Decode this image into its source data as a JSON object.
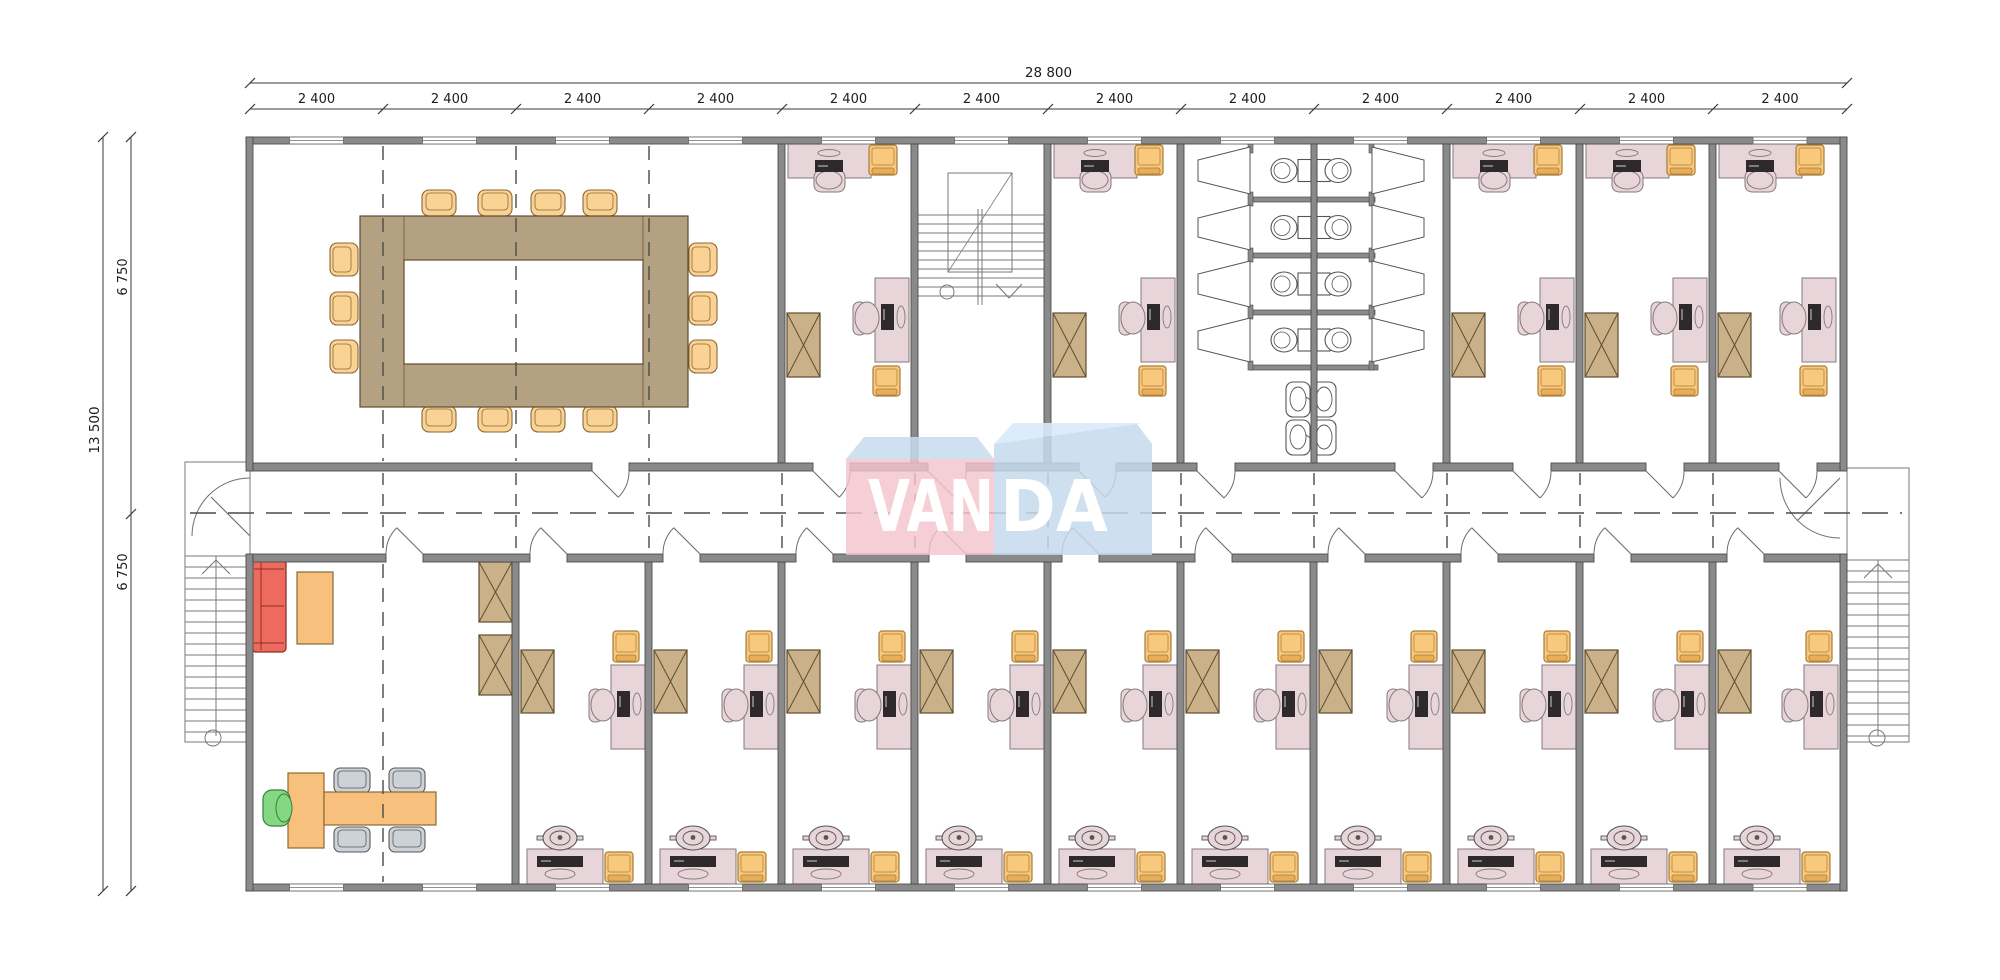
{
  "watermark": {
    "left_text": "VAN",
    "right_text": "DA"
  },
  "dimensions": {
    "top_total_label": "28 800",
    "top_segment_labels": [
      "2 400",
      "2 400",
      "2 400",
      "2 400",
      "2 400",
      "2 400",
      "2 400",
      "2 400",
      "2 400",
      "2 400",
      "2 400",
      "2 400"
    ],
    "left_total_label": "13 500",
    "left_segment_labels": [
      "6 750",
      "6 750"
    ]
  },
  "colors": {
    "paper": "#ffffff",
    "wall": "#8a8a8a",
    "wallEdge": "#4c4c4c",
    "thinLine": "#6e6e6e",
    "stairLine": "#7a7a7a",
    "dash": "#4a4a4a",
    "dimLine": "#3a3a3a",
    "dimText": "#1c1c1c",
    "deskPink": "#e7d5d9",
    "deskEdge": "#84797c",
    "monitor": "#2e2a2b",
    "chairOrange": "#f8c87d",
    "chairOrangeEdge": "#a87c38",
    "chairOrangeDark": "#e8ae58",
    "cabinet": "#cab189",
    "cabinetEdge": "#5e4e30",
    "tableTan": "#b4a182",
    "confChair": "#fad294",
    "confChairEdge": "#8a6a3a",
    "sofaRed": "#ee6a5f",
    "sofaEdge": "#8a2f28",
    "teal": "#7fc9c9",
    "tableOrange": "#f7c07c",
    "tableOrangeEdge": "#8a6a30",
    "chairGreen": "#84d883",
    "chairGreenEdge": "#35803a",
    "chairGray": "#ccd2d8",
    "chairGrayEdge": "#5a5a5a",
    "fixture": "#ffffff",
    "fixtureEdge": "#555555",
    "logoPink": "#f4c3cc",
    "logoBlue": "#c5d9ec",
    "logoTopFace": "#c7dbef",
    "logoTopFaceLight": "#d9eaf9",
    "logoText": "#ffffff"
  },
  "plan": {
    "width": 2000,
    "height": 980,
    "bays": [
      250,
      383,
      516,
      649,
      782,
      915,
      1048,
      1181,
      1314,
      1447,
      1580,
      1713,
      1847
    ],
    "wall": {
      "t": 7,
      "topY": 137,
      "bottomY": 884,
      "leftX": 246,
      "rightX": 1840
    },
    "corridor": {
      "wallTopY": 463,
      "wallBotY": 554,
      "t": 8,
      "centerY": 513
    },
    "window_width": 54,
    "doors": {
      "top_gaps": [
        [
          592,
          629
        ],
        [
          813,
          850
        ],
        [
          928,
          966
        ],
        [
          1079,
          1116
        ],
        [
          1197,
          1235
        ],
        [
          1395,
          1433
        ],
        [
          1513,
          1551
        ],
        [
          1646,
          1684
        ],
        [
          1779,
          1817
        ]
      ],
      "bottom_gaps": [
        [
          386,
          423
        ],
        [
          530,
          567
        ],
        [
          663,
          700
        ],
        [
          796,
          833
        ],
        [
          929,
          966
        ],
        [
          1062,
          1099
        ],
        [
          1195,
          1232
        ],
        [
          1328,
          1365
        ],
        [
          1461,
          1498
        ],
        [
          1594,
          1631
        ],
        [
          1727,
          1764
        ]
      ]
    },
    "walls_top_zone": [
      778,
      911,
      1044,
      1177,
      1443,
      1576,
      1709
    ],
    "walls_bottom_zone": [
      512,
      645,
      778,
      911,
      1044,
      1177,
      1310,
      1443,
      1576,
      1709
    ],
    "rooms": {
      "conference": {
        "x1": 253,
        "x2": 778,
        "grid": [
          383,
          516,
          649
        ]
      },
      "offices_top": [
        [
          785,
          911
        ],
        [
          1051,
          1177
        ],
        [
          1450,
          1576
        ],
        [
          1583,
          1709
        ],
        [
          1716,
          1838
        ]
      ],
      "offices_bottom": [
        [
          519,
          645
        ],
        [
          652,
          778
        ],
        [
          785,
          911
        ],
        [
          918,
          1044
        ],
        [
          1051,
          1177
        ],
        [
          1184,
          1310
        ],
        [
          1317,
          1443
        ],
        [
          1450,
          1576
        ],
        [
          1583,
          1709
        ],
        [
          1716,
          1838
        ]
      ],
      "reception": {
        "x1": 253,
        "x2": 512,
        "grid": [
          383
        ]
      },
      "wc": {
        "x1": 1184,
        "x2": 1443,
        "center": 1311,
        "dividers": [
          197,
          253,
          310
        ],
        "rows": [
          [
            144,
            197
          ],
          [
            202,
            253
          ],
          [
            258,
            310
          ],
          [
            315,
            365
          ]
        ],
        "stallBottom": 365,
        "sink_rows": [
          382,
          420
        ]
      },
      "stairwell": {
        "x1": 918,
        "x2": 1044
      }
    },
    "stairs": {
      "left": {
        "landing": [
          185,
          462,
          65,
          94
        ],
        "box": [
          185,
          556,
          62,
          186
        ],
        "rail": 216,
        "circle": [
          213,
          738
        ]
      },
      "right": {
        "landing": [
          1847,
          468,
          62,
          92
        ],
        "box": [
          1847,
          560,
          62,
          182
        ],
        "rail": 1878,
        "circle": [
          1877,
          738
        ]
      },
      "inner": {
        "x1": 917,
        "x2": 1044,
        "treadY0": 215,
        "treadStep": 9,
        "treadN": 10,
        "outline": [
          948,
          173,
          64,
          99
        ],
        "rail": 978,
        "circle": [
          947,
          292
        ]
      }
    },
    "conference_table": {
      "outer": [
        360,
        216,
        328,
        191
      ],
      "inner": [
        404,
        260,
        239,
        104
      ],
      "chairs_top_x": [
        422,
        478,
        531,
        583
      ],
      "chairs_top_y": 190,
      "chairs_bot_y": 406,
      "chairs_side_y": [
        243,
        292,
        340
      ],
      "chairs_left_x": 330,
      "chairs_right_x": 689
    },
    "reception_items": {
      "teal_top": [
        249,
        556,
        40,
        5
      ],
      "teal_left": [
        249,
        556,
        4,
        96
      ],
      "sofa": [
        252,
        560,
        34,
        92
      ],
      "coffee_table": [
        297,
        572,
        36,
        72
      ],
      "desk_vert": [
        288,
        773,
        36,
        75
      ],
      "desk_table": [
        324,
        792,
        112,
        33
      ],
      "green_chair": [
        263,
        790,
        27,
        36
      ],
      "gray_chairs": [
        [
          334,
          768
        ],
        [
          389,
          768
        ],
        [
          334,
          827
        ],
        [
          389,
          827
        ]
      ],
      "cabinets": [
        [
          479,
          562
        ],
        [
          479,
          635
        ]
      ]
    },
    "dims": {
      "top_total_y": 83,
      "top_seg_y": 109,
      "left_total_x": 103,
      "left_seg_x": 131,
      "left_label_pos": [
        99,
        430
      ],
      "left_seg_label_pos": [
        [
          127,
          277
        ],
        [
          127,
          572
        ]
      ]
    },
    "logo": {
      "pink_box": [
        846,
        459,
        148,
        96
      ],
      "pink_top": "846,459 864,437 977,437 994,459",
      "blue_box": "994,444 1137,424 1152,444 1152,555 994,555",
      "blue_top": "994,444 1013,423 1141,423 1137,424",
      "van_pos": [
        931,
        531
      ],
      "da_pos": [
        1054,
        531
      ],
      "van_len": 126,
      "da_len": 108,
      "font_size": 71
    }
  }
}
